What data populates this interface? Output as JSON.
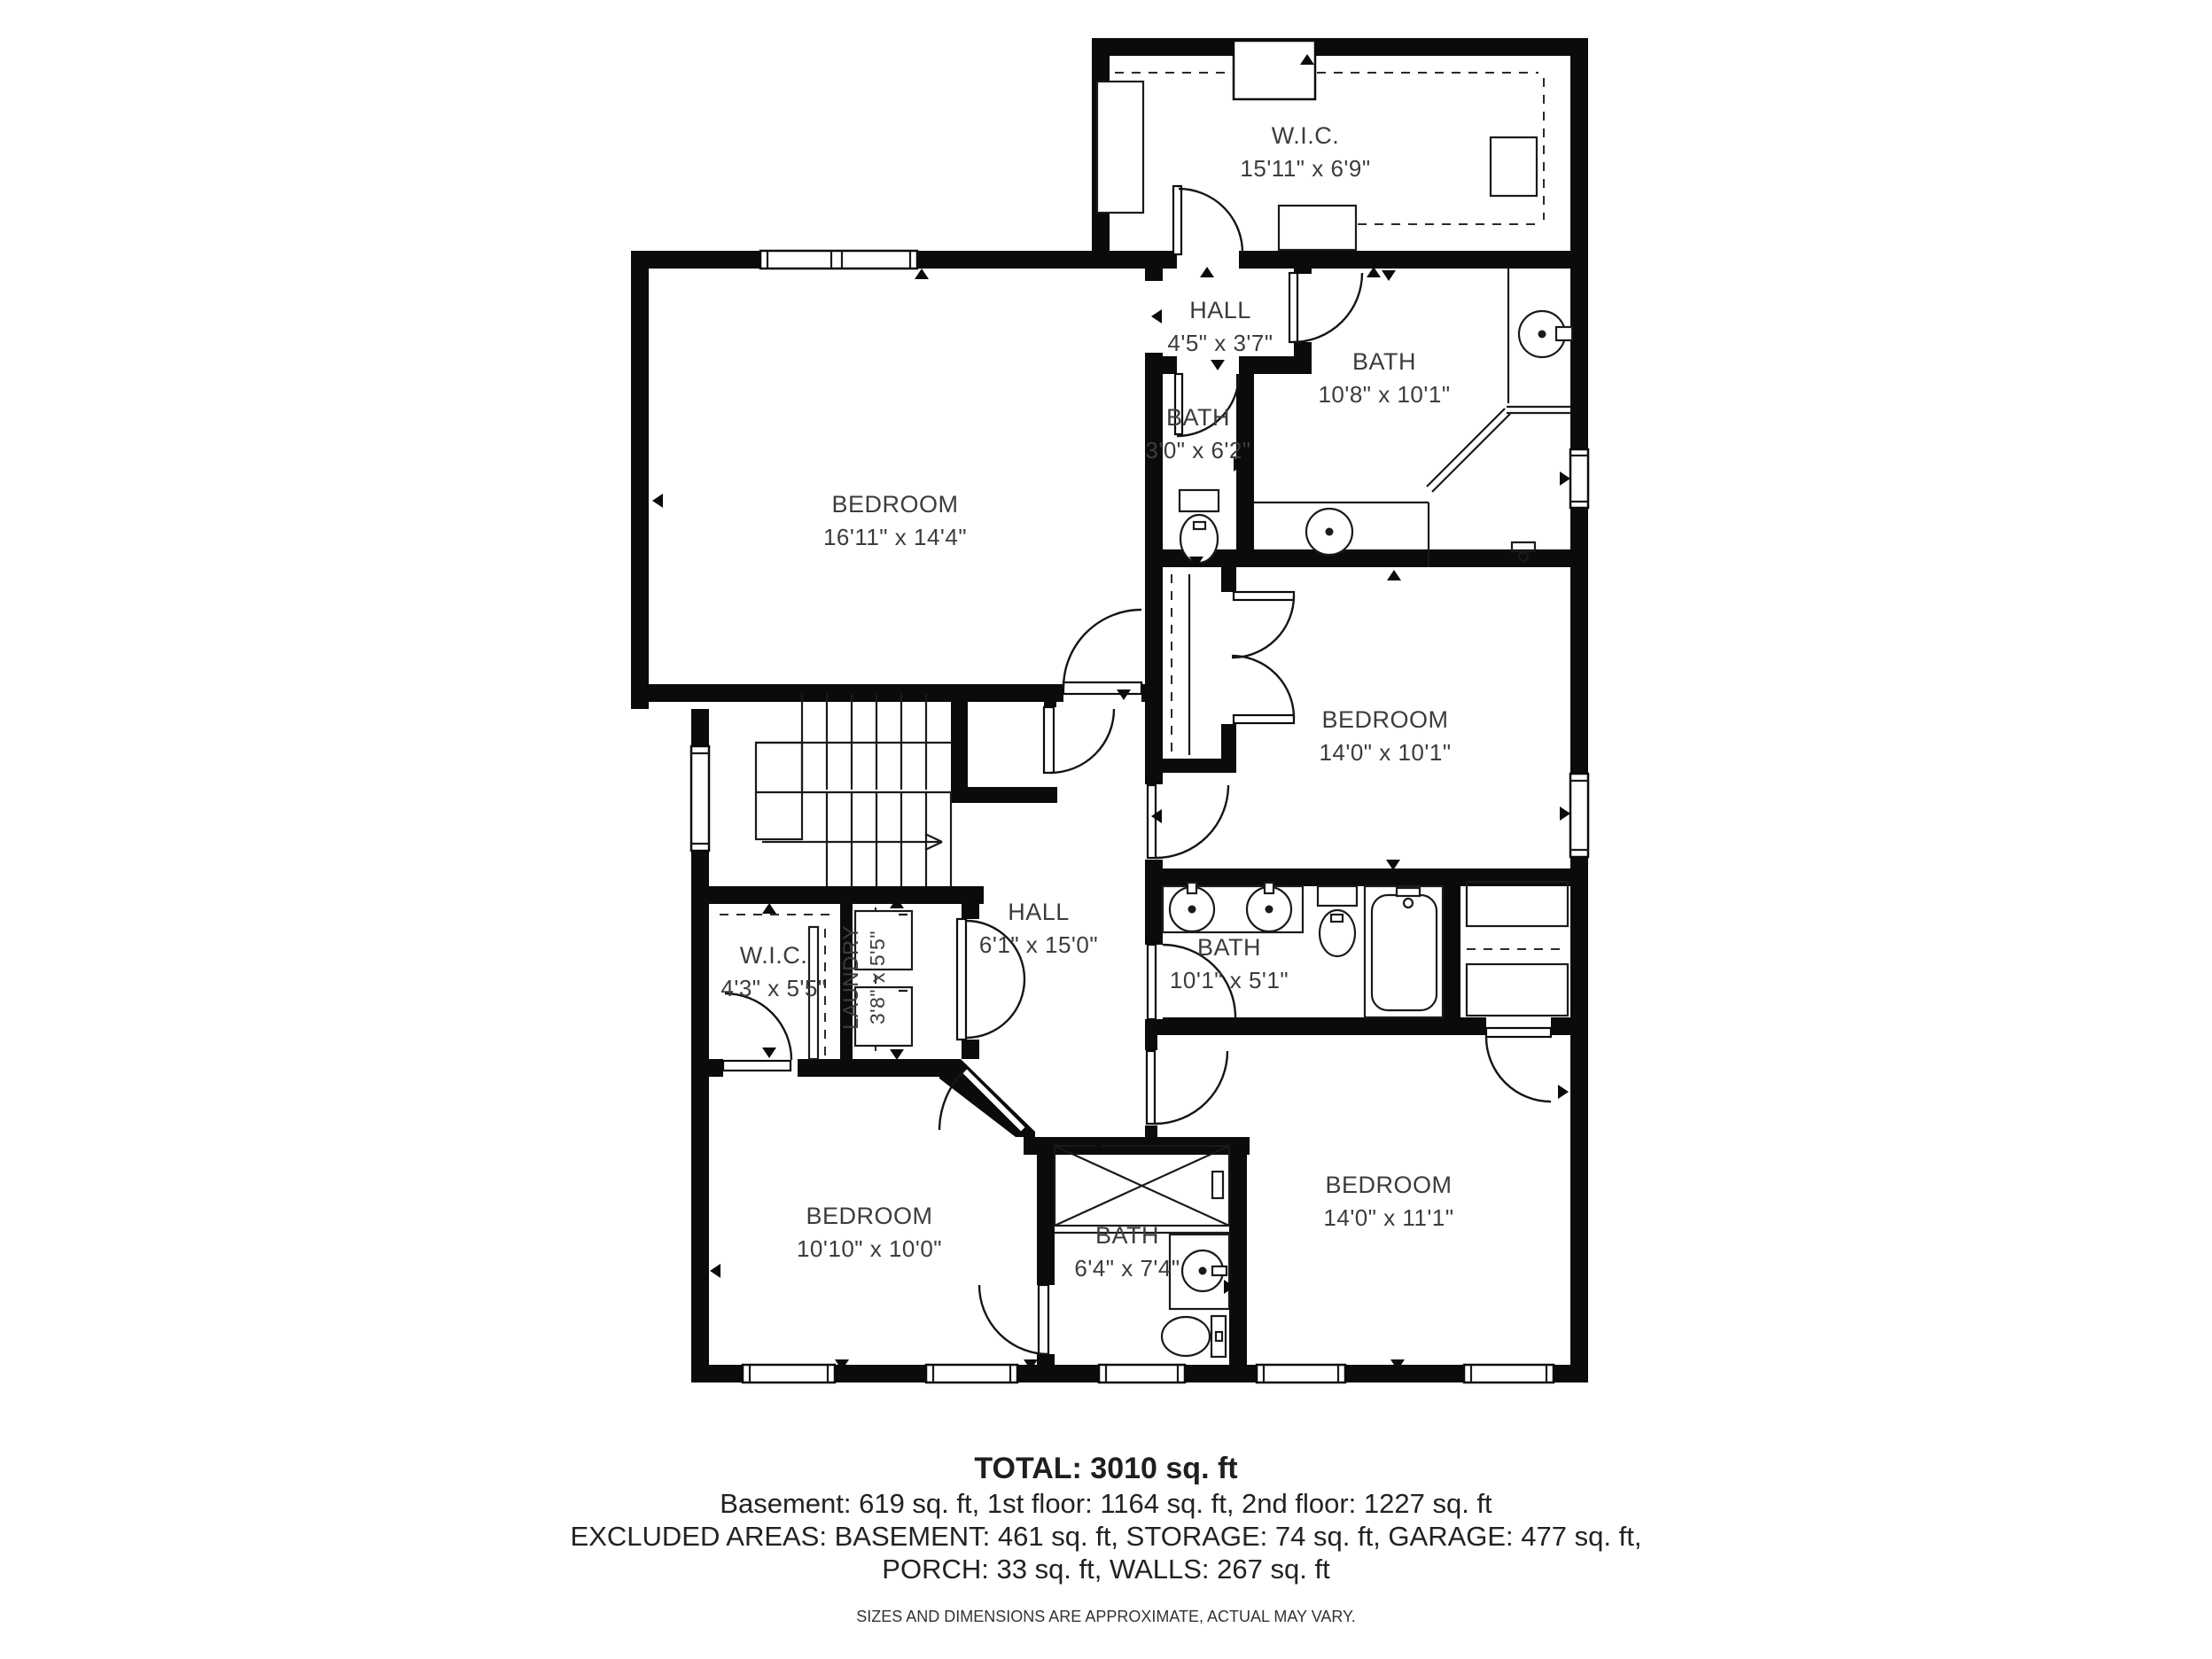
{
  "meta": {
    "type": "2nd floor residential floor plan",
    "wall_color": "#0b0b0b",
    "background_color": "#ffffff",
    "text_color": "#3c3c3c"
  },
  "rooms": {
    "wic_top": {
      "name": "W.I.C.",
      "dims": "15'11\" x 6'9\""
    },
    "hall_upper": {
      "name": "HALL",
      "dims": "4'5\" x 3'7\""
    },
    "bath_upper": {
      "name": "BATH",
      "dims": "10'8\" x 10'1\""
    },
    "bath_small": {
      "name": "BATH",
      "dims": "3'0\" x 6'2\""
    },
    "bedroom_master": {
      "name": "BEDROOM",
      "dims": "16'11\" x 14'4\""
    },
    "bedroom_right": {
      "name": "BEDROOM",
      "dims": "14'0\" x 10'1\""
    },
    "hall_main": {
      "name": "HALL",
      "dims": "6'1\" x 15'0\""
    },
    "wic_small": {
      "name": "W.I.C.",
      "dims": "4'3\" x 5'5\""
    },
    "laundry": {
      "name": "LAUNDRY",
      "dims": "3'8\" x 5'5\""
    },
    "bath_hall": {
      "name": "BATH",
      "dims": "10'1\" x 5'1\""
    },
    "bedroom_bottom_left": {
      "name": "BEDROOM",
      "dims": "10'10\" x 10'0\""
    },
    "bath_ensuite": {
      "name": "BATH",
      "dims": "6'4\" x 7'4\""
    },
    "bedroom_bottom_right": {
      "name": "BEDROOM",
      "dims": "14'0\" x 11'1\""
    }
  },
  "footer": {
    "total": "TOTAL: 3010 sq. ft",
    "floors": "Basement: 619 sq. ft, 1st floor: 1164 sq. ft, 2nd floor: 1227 sq. ft",
    "excluded_line1": "EXCLUDED AREAS: BASEMENT: 461 sq. ft, STORAGE: 74 sq. ft, GARAGE: 477 sq. ft,",
    "excluded_line2": "PORCH: 33 sq. ft, WALLS: 267 sq. ft",
    "disclaimer": "SIZES AND DIMENSIONS ARE APPROXIMATE, ACTUAL MAY VARY."
  }
}
